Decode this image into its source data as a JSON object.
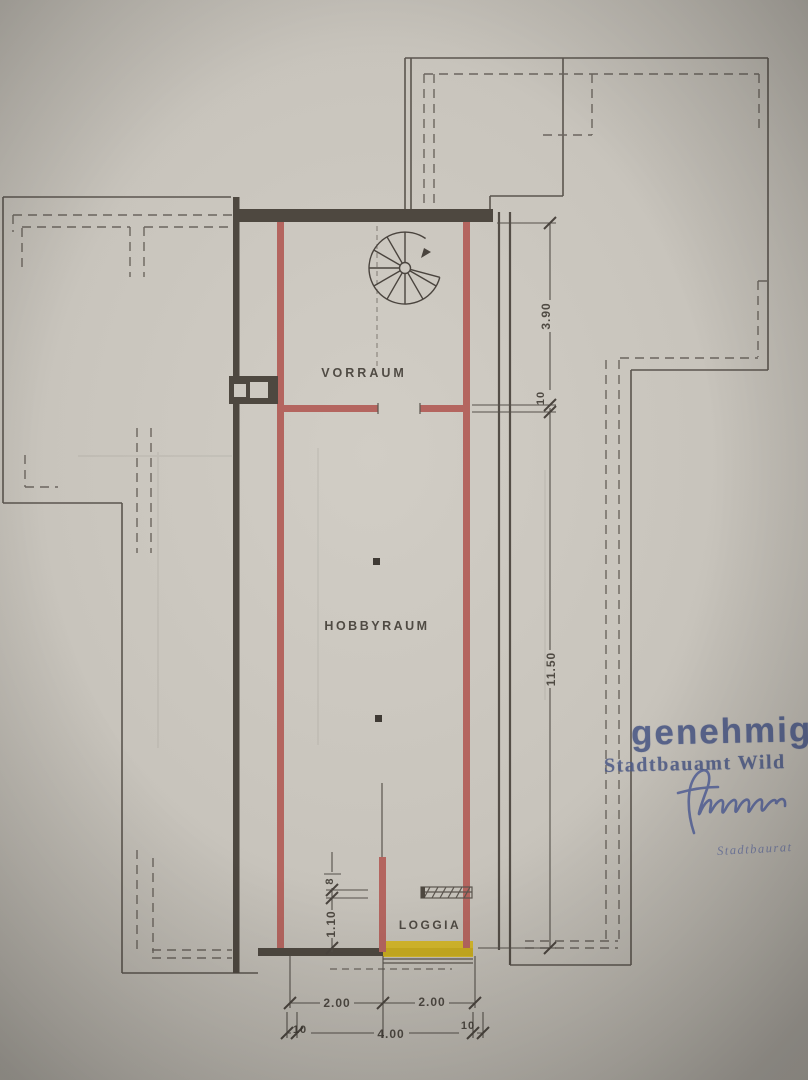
{
  "plan": {
    "room_labels": {
      "vorraum": "VORRAUM",
      "hobbyraum": "HOBBYRAUM",
      "loggia": "LOGGIA"
    },
    "dimensions": {
      "right_top": "3.90",
      "right_wall": "10",
      "right_main": "11.50",
      "left_small_top": "8",
      "left_small_bottom": "1.10",
      "bottom_left_half": "2.00",
      "bottom_right_half": "2.00",
      "bottom_wall_left": "10",
      "bottom_total": "4.00",
      "bottom_wall_right": "10"
    }
  },
  "stamp": {
    "approval_word": "genehmig",
    "authority": "Stadtbauamt Wild",
    "signer_title": "Stadtbaurat"
  },
  "colors": {
    "wall_red": "#b4655f",
    "highlight_yellow": "#d4b51c",
    "stamp_blue": "#4e5b87",
    "ink_dark": "#4e4840",
    "line_gray": "#5b554e",
    "paper": "#c8c4bc"
  }
}
